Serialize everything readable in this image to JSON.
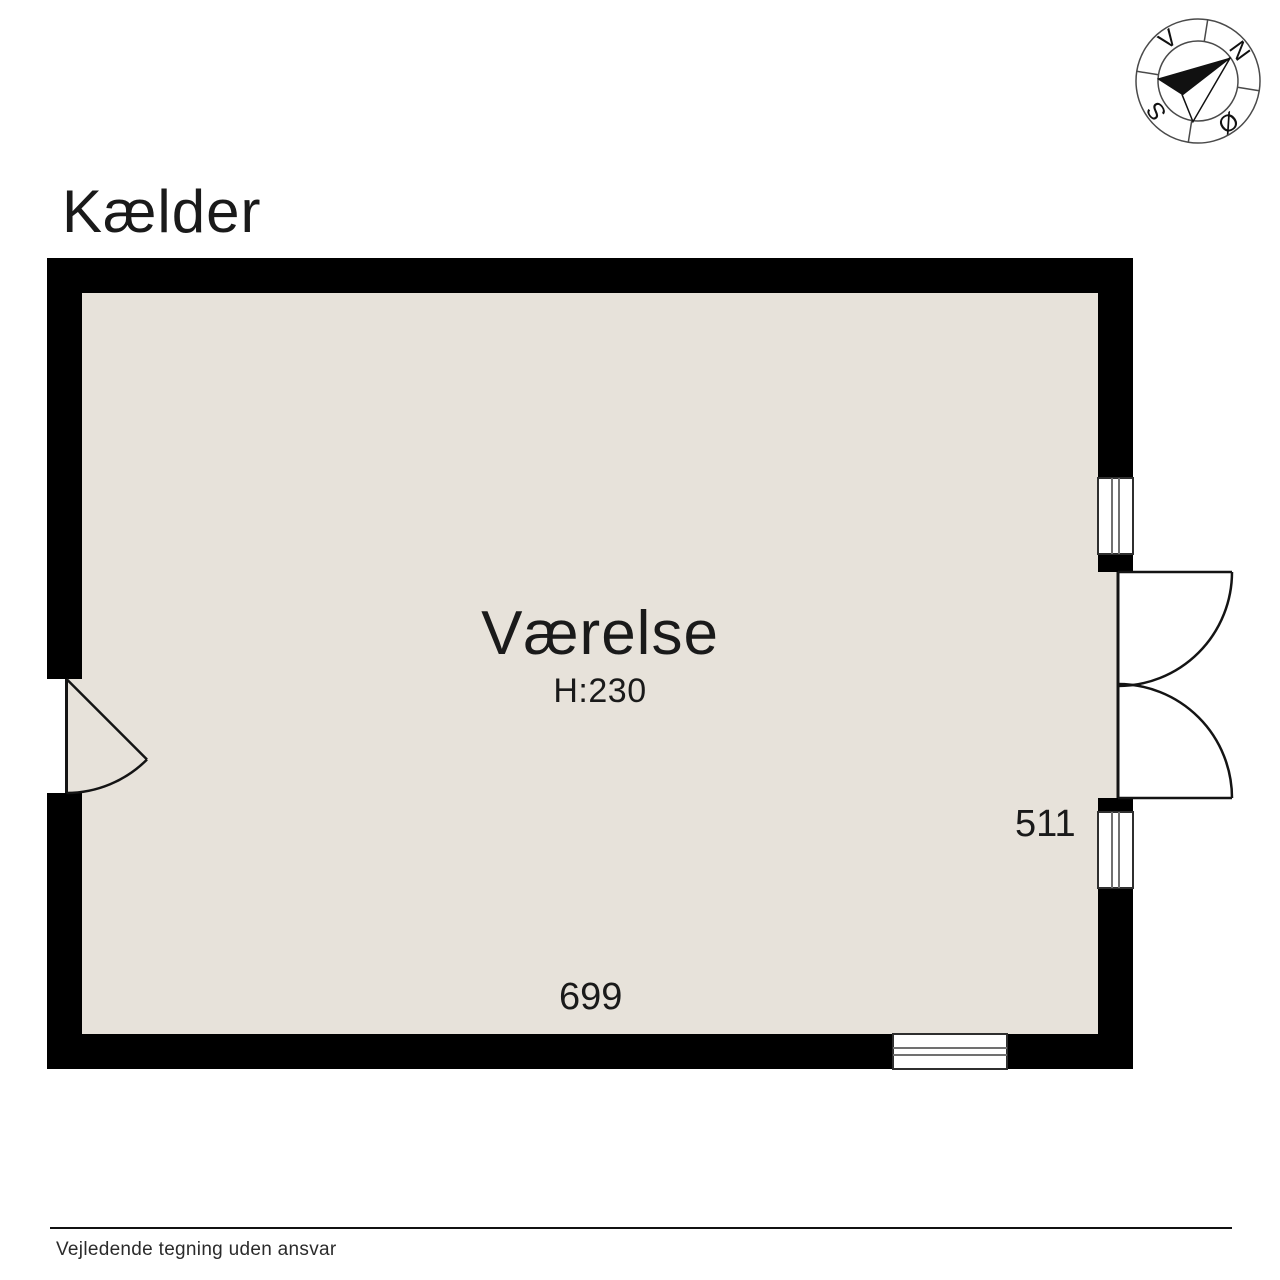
{
  "title": "Kælder",
  "room": {
    "name": "Værelse",
    "ceiling_height": "H:230",
    "width_dim": "699",
    "depth_dim": "511"
  },
  "compass": {
    "north": "N",
    "south": "S",
    "east": "Ø",
    "west": "V"
  },
  "footer": {
    "disclaimer": "Vejledende tegning uden ansvar"
  },
  "colors": {
    "background": "#ffffff",
    "floor": "#e7e2da",
    "wall": "#000000",
    "line": "#141414",
    "text": "#1a1a1a"
  }
}
